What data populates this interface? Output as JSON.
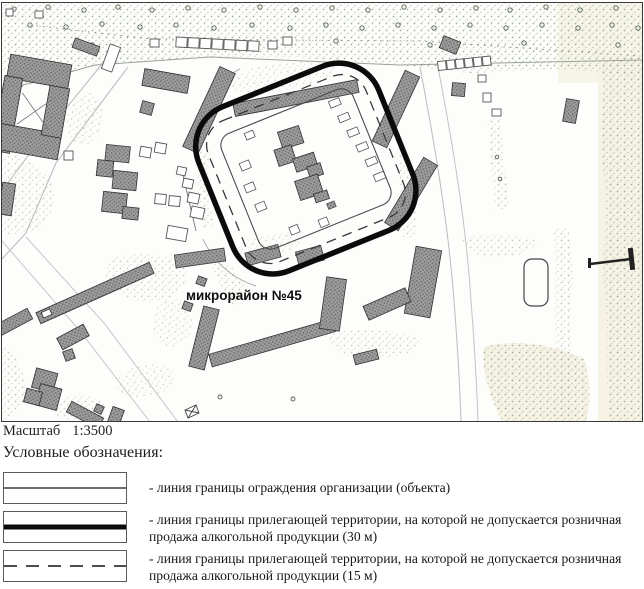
{
  "map": {
    "district_label": "микрорайон №45",
    "scale_label": "Масштаб",
    "scale_value": "1:3500"
  },
  "legend": {
    "title": "Условные обозначения:",
    "items": [
      {
        "style": "thin-solid-line",
        "text": "- линия границы ограждения организации (объекта)"
      },
      {
        "style": "thick-solid-line",
        "text": "- линия границы прилегающей территории, на которой не допускается розничная продажа алкогольной продукции (30 м)"
      },
      {
        "style": "dashed-line",
        "text": "- линия границы прилегающей территории, на которой не допускается розничная продажа алкогольной продукции (15 м)"
      }
    ]
  },
  "colors": {
    "boundary_30m": "#0b0b0b",
    "boundary_15m_dash": "#3a3a3a",
    "fence_line": "#4a4a4a",
    "building_fill": "#9a9a9a",
    "vegetation_dot": "#9fb399",
    "paper_tint": "#f6f2e4"
  }
}
